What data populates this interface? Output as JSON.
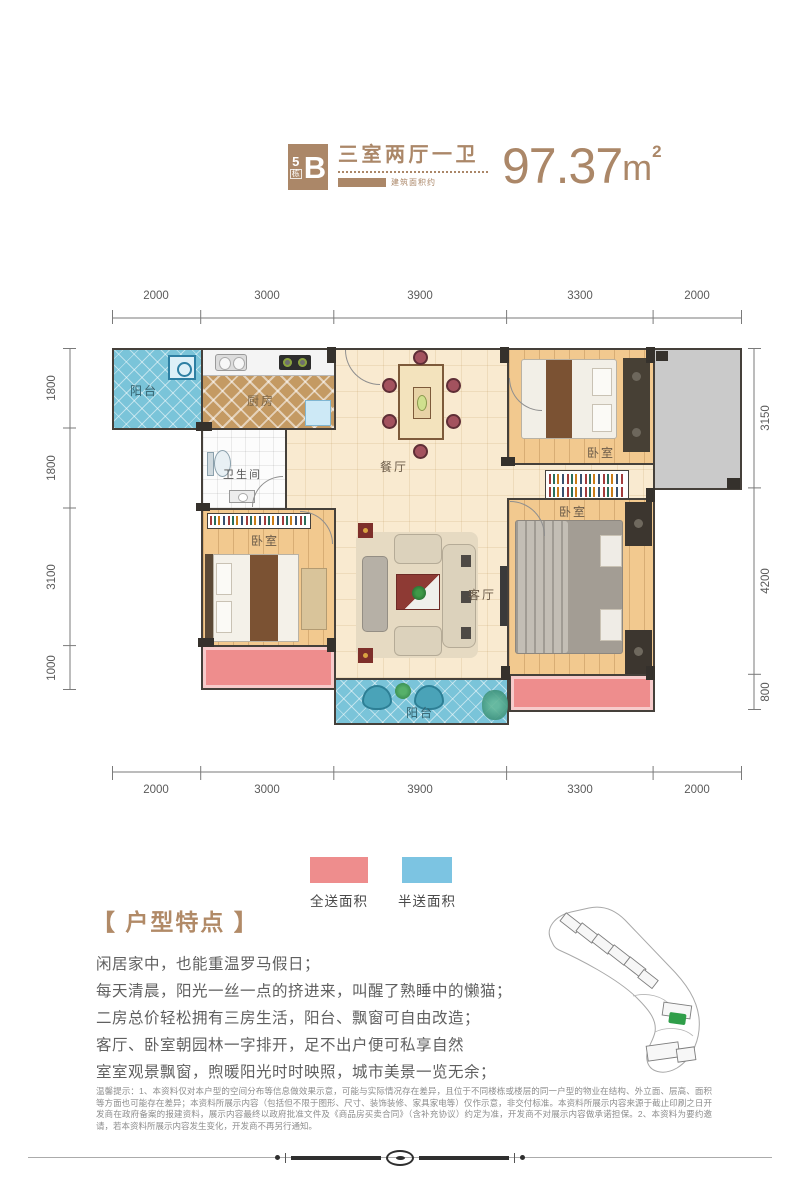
{
  "header": {
    "badge": {
      "building_number": "5",
      "building_suffix": "栋",
      "unit_letter": "B"
    },
    "layout_type": "三室两厅一卫",
    "area_label": "建筑面积约",
    "area_value": "97.37",
    "area_unit": "m",
    "area_exponent": "2"
  },
  "plan": {
    "dims_top": [
      "2000",
      "3000",
      "3900",
      "3300",
      "2000"
    ],
    "dims_bottom": [
      "2000",
      "3000",
      "3900",
      "3300",
      "2000"
    ],
    "dims_left": [
      "1800",
      "1800",
      "3100",
      "1000"
    ],
    "dims_right": [
      "3150",
      "4200",
      "800"
    ],
    "rooms": {
      "balcony_top": "阳台",
      "kitchen": "厨房",
      "bathroom": "卫生间",
      "dining": "餐厅",
      "bedroom_top_right": "卧室",
      "bedroom_left": "卧室",
      "living": "客厅",
      "bedroom_right": "卧室",
      "balcony_bottom": "阳台"
    }
  },
  "legend": {
    "full_gift": {
      "label": "全送面积",
      "color": "#ee8d8d"
    },
    "half_gift": {
      "label": "半送面积",
      "color": "#7cc4e2"
    }
  },
  "features": {
    "title": "【 户型特点 】",
    "lines": [
      "闲居家中，也能重温罗马假日；",
      "每天清晨，阳光一丝一点的挤进来，叫醒了熟睡中的懒猫；",
      "二房总价轻松拥有三房生活，阳台、飘窗可自由改造；",
      "客厅、卧室朝园林一字排开，足不出户便可私享自然",
      "室室观景飘窗，煦暖阳光时时映照，城市美景一览无余；"
    ]
  },
  "disclaimer": "温馨提示：1、本资料仅对本户型的空间分布等信息做效果示意，可能与实际情况存在差异，且位于不同楼栋或楼层的同一户型的物业在结构、外立面、层高、面积等方面也可能存在差异；本资料所展示内容（包括但不限于图形、尺寸、装饰装修、家具家电等）仅作示意，非交付标准。本资料所展示内容来源于截止印刷之日开发商在政府备案的报建资料，展示内容最终以政府批准文件及《商品房买卖合同》（含补充协议）约定为准，开发商不对展示内容做承诺担保。2、本资料为要约邀请，若本资料所展示内容发生变化，开发商不再另行通知。",
  "colors": {
    "brand_brown": "#ab8768",
    "wall_dark": "#45403a",
    "floor_cream": "#f9ead0",
    "wood_floor": "#f2c98f",
    "balcony_blue": "#7ac4d9",
    "gift_pink": "#ee8d8d",
    "gray_area": "#cacaca"
  }
}
